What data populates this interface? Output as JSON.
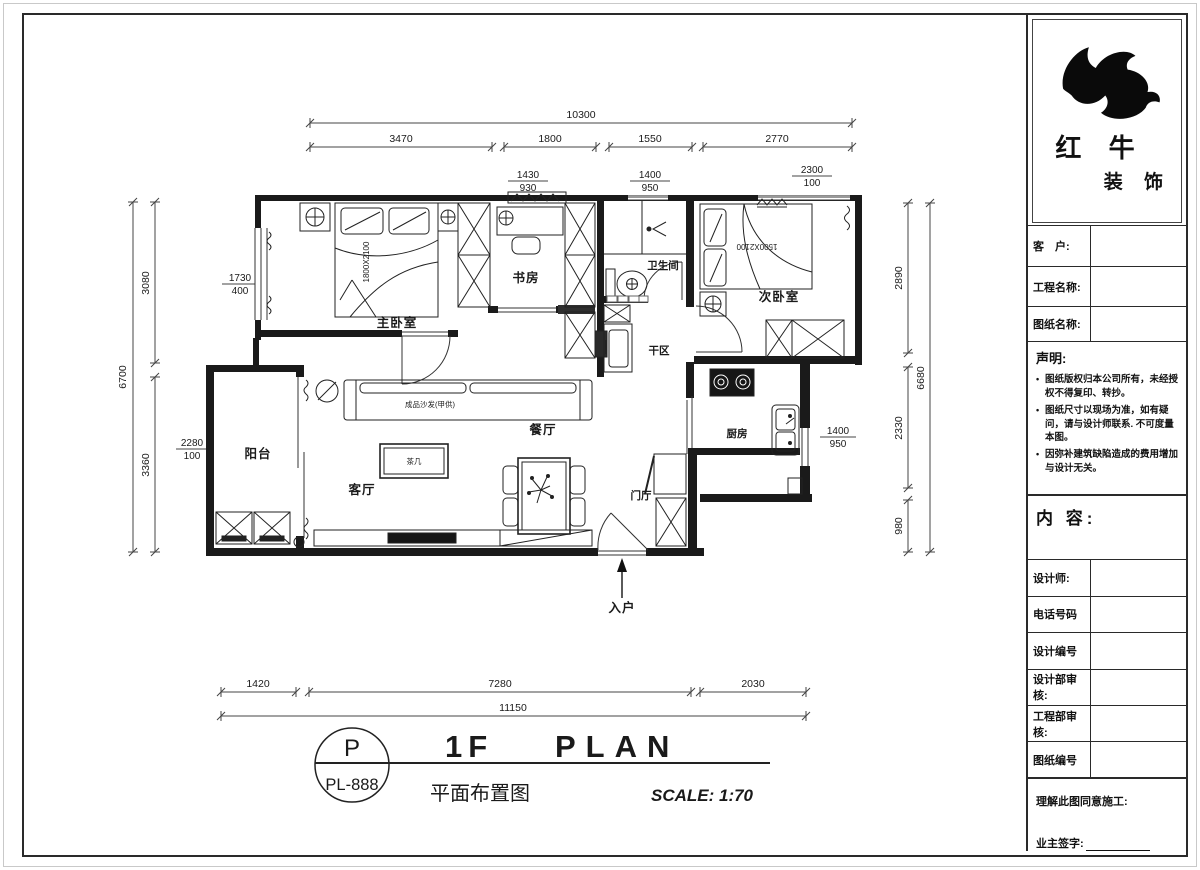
{
  "title": {
    "letter": "P",
    "code": "PL-888",
    "en_1f": "1F",
    "en_plan": "PLAN",
    "cn": "平面布置图",
    "scale": "SCALE: 1:70"
  },
  "rooms": {
    "master": "主卧室",
    "study": "书房",
    "bath": "卫生间",
    "second": "次卧室",
    "dry": "干区",
    "dining": "餐厅",
    "kitchen": "厨房",
    "living": "客厅",
    "balcony": "阳台",
    "foyer": "门厅",
    "entry": "入户"
  },
  "furniture": {
    "sofa": "成品沙发(甲供)",
    "tea_table": "茶几",
    "bed_master": "1800X2100",
    "bed_second": "1500X2100"
  },
  "dims": {
    "top_total": "10300",
    "top_segments": [
      "3470",
      "1800",
      "1550",
      "2770"
    ],
    "top_fracs": [
      {
        "n": "1430",
        "d": "930"
      },
      {
        "n": "1400",
        "d": "950"
      },
      {
        "n": "2300",
        "d": "100"
      }
    ],
    "left_total": "6700",
    "left_segments": [
      "3080",
      "3360"
    ],
    "left_fracs": [
      {
        "n": "1730",
        "d": "400"
      },
      {
        "n": "2280",
        "d": "100"
      }
    ],
    "right_total": "6680",
    "right_segments": [
      "2890",
      "2330",
      "980"
    ],
    "right_frac": {
      "n": "1400",
      "d": "950"
    },
    "bottom_total": "11150",
    "bottom_segments": [
      "1420",
      "7280",
      "2030"
    ]
  },
  "titleblock": {
    "logo_line1": "红 牛",
    "logo_line2": "装 饰",
    "fields_top": [
      {
        "label": "客　户:"
      },
      {
        "label": "工程名称:"
      },
      {
        "label": "图纸名称:"
      }
    ],
    "statement": {
      "title": "声明:",
      "items": [
        "图纸版权归本公司所有，未经授权不得复印、转抄。",
        "图纸尺寸以现场为准，如有疑问，请与设计师联系. 不可度量本图。",
        "因弥补建筑缺陷造成的费用增加与设计无关。"
      ]
    },
    "content_label": "内 容:",
    "fields_bottom": [
      {
        "label": "设计师:"
      },
      {
        "label": "电话号码"
      },
      {
        "label": "设计编号"
      },
      {
        "label": "设计部审核:"
      },
      {
        "label": "工程部审核:"
      },
      {
        "label": "图纸编号"
      }
    ],
    "footer": {
      "line1": "理解此图同意施工:",
      "line2": "业主签字:"
    }
  }
}
